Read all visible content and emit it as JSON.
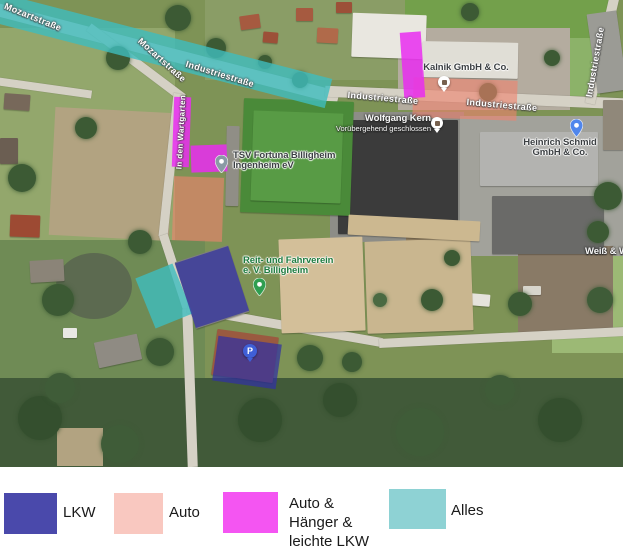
{
  "legend": {
    "items": [
      {
        "label_lines": [
          "LKW"
        ],
        "color": "#4a49ab"
      },
      {
        "label_lines": [
          "Auto"
        ],
        "color": "#f9c8c0"
      },
      {
        "label_lines": [
          "Auto &",
          "Hänger &",
          "leichte LKW"
        ],
        "color": "#f455f2"
      },
      {
        "label_lines": [
          "Alles"
        ],
        "color": "#8ed2d4"
      }
    ]
  },
  "map_data": {
    "street_labels": [
      {
        "text": "Mozartstraße",
        "x": 33,
        "y": 17,
        "rot": 22,
        "size": 9
      },
      {
        "text": "Mozartstraße",
        "x": 162,
        "y": 60,
        "rot": 42,
        "size": 9
      },
      {
        "text": "Industriestraße",
        "x": 220,
        "y": 74,
        "rot": 17,
        "size": 9
      },
      {
        "text": "Industriestraße",
        "x": 383,
        "y": 98,
        "rot": 5,
        "size": 9
      },
      {
        "text": "Industriestraße",
        "x": 502,
        "y": 105,
        "rot": 5,
        "size": 9
      },
      {
        "text": "Industriestraße",
        "x": 595,
        "y": 62,
        "rot": -80,
        "size": 9
      },
      {
        "text": "In den Wartgarten",
        "x": 181,
        "y": 132,
        "rot": -87,
        "size": 8
      }
    ],
    "pois": [
      {
        "id": "tsv-fortuna",
        "lines": [
          "TSV Fortuna Billigheim",
          "Ingenheim eV"
        ],
        "halo": "light",
        "anchor": "left",
        "x": 233,
        "y": 151,
        "pin": {
          "type": "teardrop",
          "color": "#8a9aa5",
          "x": 221,
          "y": 173
        }
      },
      {
        "id": "wolfgang-kern",
        "lines": [
          "Wolfgang Kern"
        ],
        "sub": "Vorübergehend geschlossen",
        "halo": "dark",
        "anchor": "right",
        "x": 431,
        "y": 114,
        "pin": {
          "type": "circle",
          "color": "#ffffff",
          "x": 437,
          "y": 123
        }
      },
      {
        "id": "kalnik",
        "lines": [
          "Kalnik GmbH & Co."
        ],
        "halo": "light",
        "anchor": "center",
        "x": 466,
        "y": 63,
        "pin": {
          "type": "circle",
          "color": "#ffffff",
          "x": 444,
          "y": 82
        }
      },
      {
        "id": "heinrich-schmid",
        "lines": [
          "Heinrich Schmid",
          "GmbH & Co."
        ],
        "halo": "light",
        "anchor": "center",
        "x": 560,
        "y": 138,
        "pin": {
          "type": "teardrop",
          "color": "#5086ec",
          "x": 576,
          "y": 137
        }
      },
      {
        "id": "reit-fahrverein",
        "lines": [
          "Reit- und Fahrverein",
          "e. V. Billigheim"
        ],
        "halo": "green",
        "anchor": "left",
        "x": 243,
        "y": 256,
        "pin": {
          "type": "teardrop",
          "color": "#2f9e50",
          "x": 259,
          "y": 296
        }
      },
      {
        "id": "weiss",
        "lines": [
          "Weiß & We"
        ],
        "halo": "dark",
        "anchor": "left",
        "x": 585,
        "y": 247,
        "pin": null
      },
      {
        "id": "parking",
        "lines": [],
        "halo": "light",
        "anchor": "left",
        "x": 0,
        "y": 0,
        "pin": {
          "type": "circle-label",
          "color": "#3f5fd7",
          "label": "P",
          "x": 250,
          "y": 351
        }
      }
    ],
    "overlays": [
      {
        "cat": "alles",
        "cx": 160,
        "cy": 50,
        "w": 348,
        "h": 30,
        "rot": 14.5
      },
      {
        "cat": "alles",
        "cx": 164,
        "cy": 296,
        "w": 40,
        "h": 54,
        "rot": -22
      },
      {
        "cat": "lkw",
        "cx": 212,
        "cy": 287,
        "w": 56,
        "h": 68,
        "rot": -18
      },
      {
        "cat": "lkw",
        "cx": 247,
        "cy": 362,
        "w": 64,
        "h": 45,
        "rot": 8
      },
      {
        "cat": "auto",
        "cx": 198,
        "cy": 209,
        "w": 50,
        "h": 64,
        "rot": 2
      },
      {
        "cat": "auto",
        "cx": 465,
        "cy": 99,
        "w": 104,
        "h": 40,
        "rot": 2
      },
      {
        "cat": "auto_haenger",
        "cx": 181,
        "cy": 132,
        "w": 17,
        "h": 70,
        "rot": 2
      },
      {
        "cat": "auto_haenger",
        "cx": 209,
        "cy": 158,
        "w": 36,
        "h": 27,
        "rot": -2
      },
      {
        "cat": "auto_haenger",
        "cx": 412,
        "cy": 65,
        "w": 21,
        "h": 66,
        "rot": -4
      }
    ],
    "categories": {
      "lkw": {
        "label": "LKW",
        "fill": "rgba(48,48,162,0.72)"
      },
      "auto": {
        "label": "Auto",
        "fill": "rgba(240,130,110,0.6)"
      },
      "auto_haenger": {
        "label": "Auto & Hänger & leichte LKW",
        "fill": "rgba(233,45,240,0.85)"
      },
      "alles": {
        "label": "Alles",
        "fill": "rgba(62,189,190,0.8)"
      }
    }
  }
}
